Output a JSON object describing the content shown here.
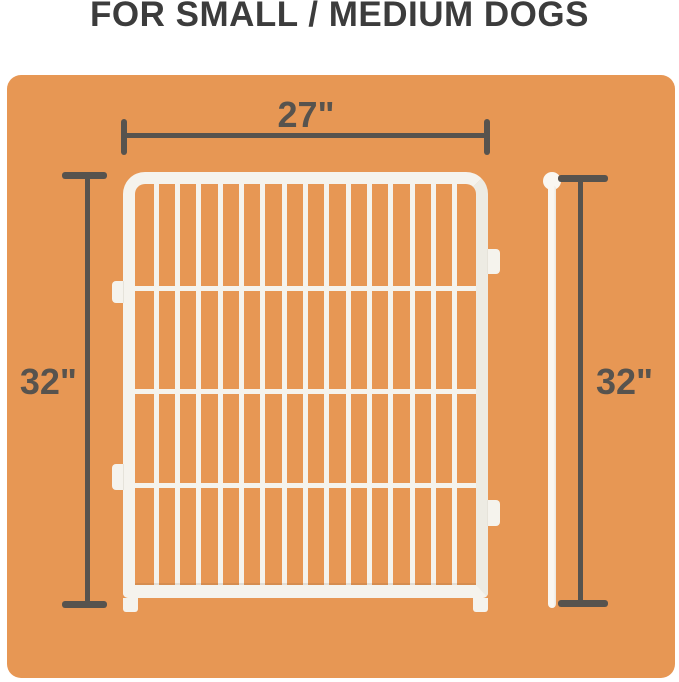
{
  "title": "FOR SMALL / MEDIUM DOGS",
  "dimensions": {
    "width_label": "27\"",
    "left_height_label": "32\"",
    "right_height_label": "32\""
  },
  "fence": {
    "vertical_bar_count": 15,
    "crossbar_tops_px": [
      102,
      205,
      299
    ]
  },
  "colors": {
    "page_background": "#ffffff",
    "panel_background": "#e79754",
    "dimension_color": "#57534e",
    "title_color": "#3c3c3c",
    "fence_white": "#f5f3ed",
    "pole_white": "#faf7f1"
  }
}
